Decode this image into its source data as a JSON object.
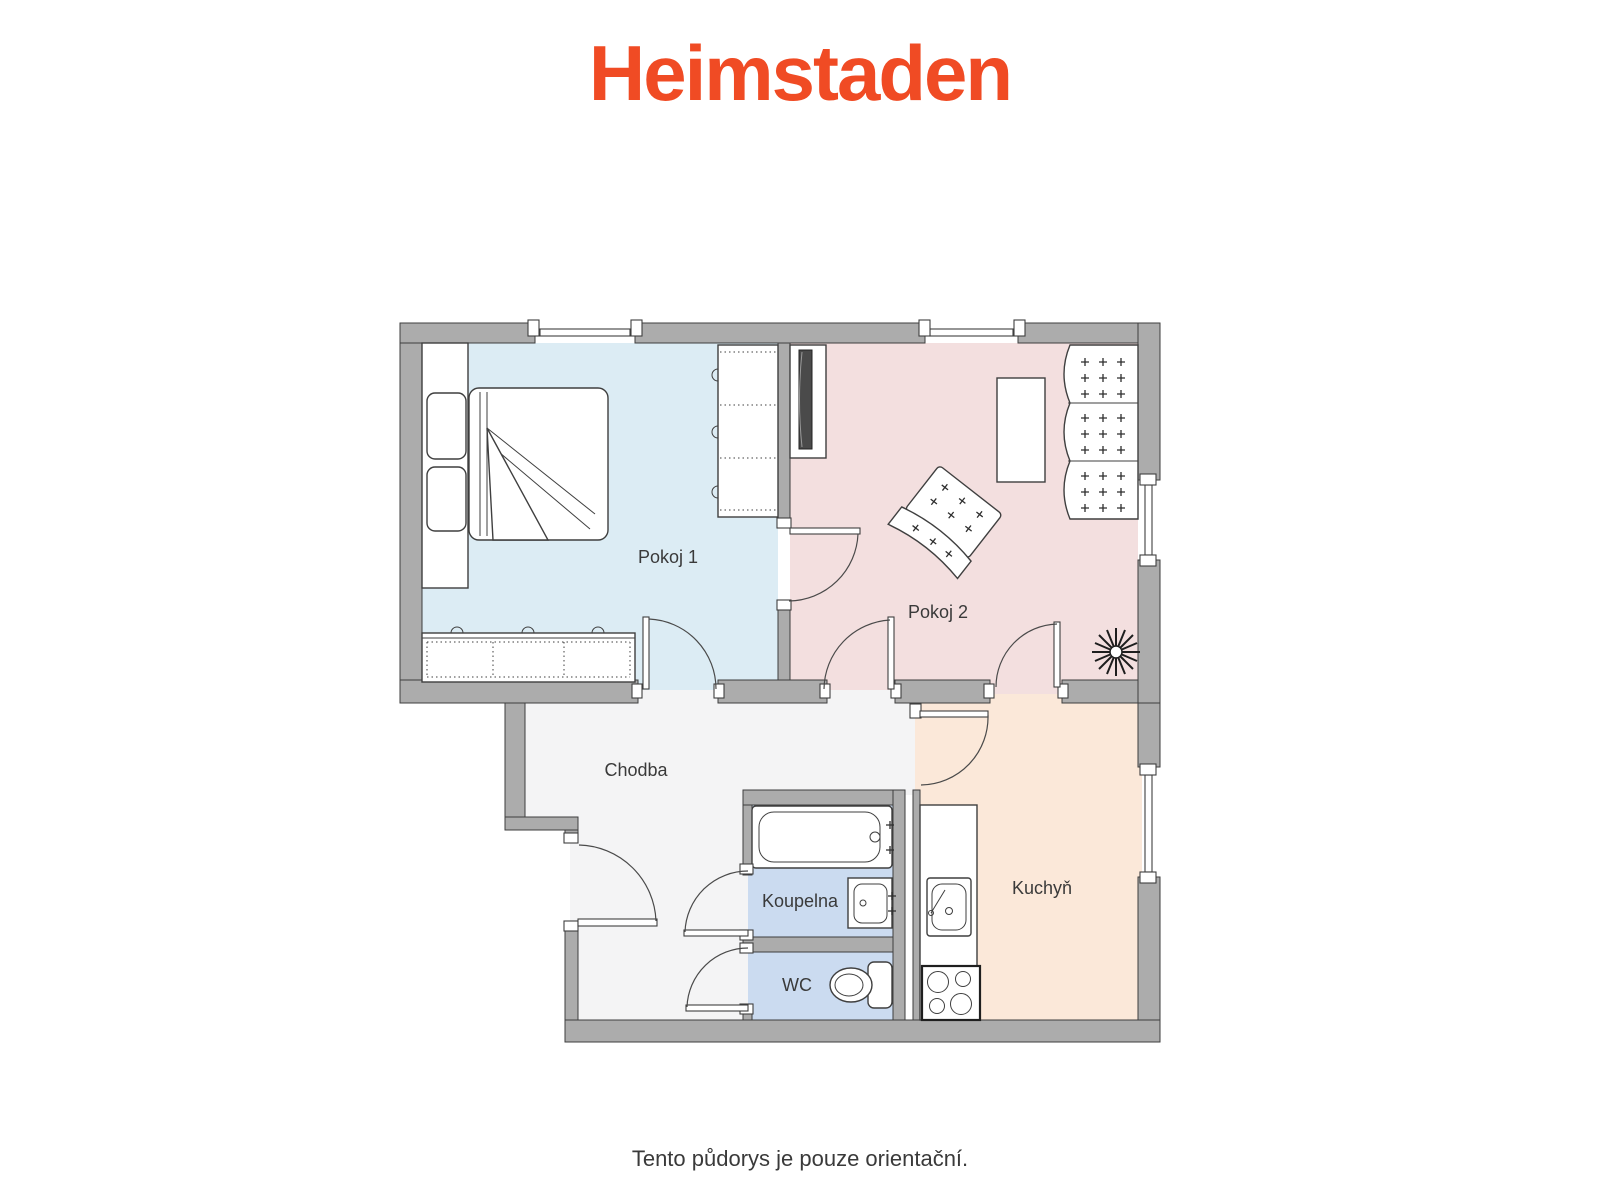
{
  "logo": {
    "text": "Heimstaden",
    "color": "#f04b24"
  },
  "rooms": [
    {
      "id": "pokoj1",
      "label": "Pokoj 1",
      "color": "#dcecf4"
    },
    {
      "id": "pokoj2",
      "label": "Pokoj 2",
      "color": "#f3dfdf"
    },
    {
      "id": "chodba",
      "label": "Chodba",
      "color": "#f4f4f5"
    },
    {
      "id": "koupelna",
      "label": "Koupelna",
      "color": "#cbdbf0"
    },
    {
      "id": "wc",
      "label": "WC",
      "color": "#cbdbf0"
    },
    {
      "id": "kuchyn",
      "label": "Kuchyň",
      "color": "#fbe8d9"
    }
  ],
  "wall_color": "#acacac",
  "disclaimer": "Tento půdorys je pouze orientační."
}
